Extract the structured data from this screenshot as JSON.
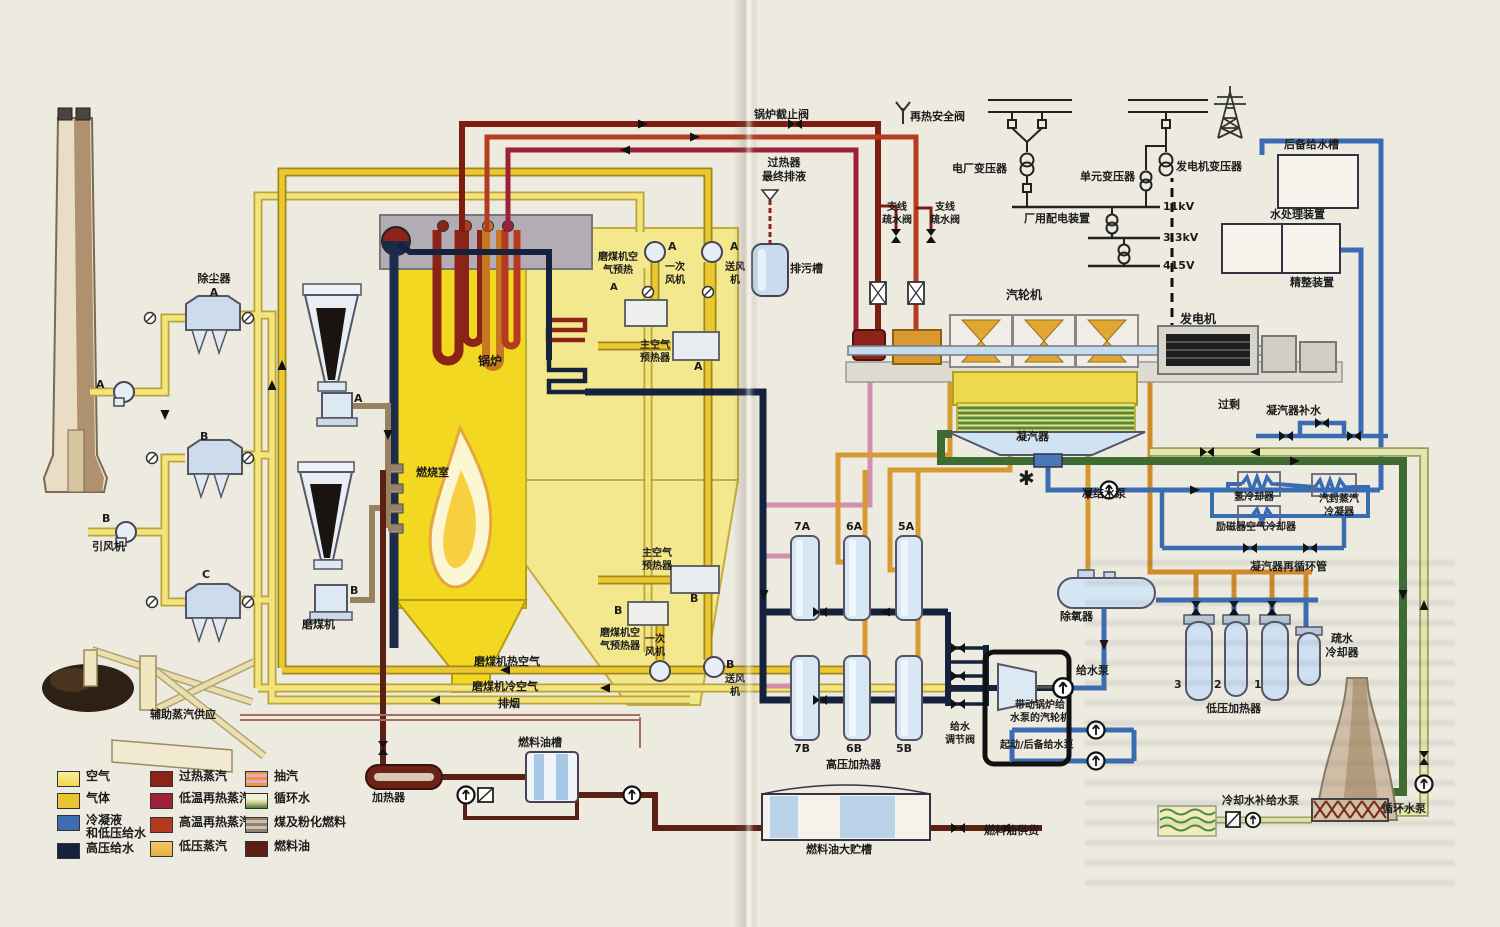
{
  "colors": {
    "air": "#f4e47e",
    "gas": "#ecc830",
    "condensate": "#3a6cb4",
    "hp_feedwater": "#15223d",
    "superheated_steam": "#7f1d10",
    "reheat_low": "#9c2038",
    "reheat_high": "#b43b20",
    "lp_steam": "#d79a30",
    "extraction": "#d58fae",
    "circulating_water": "#3d6c32",
    "circulating_return": "#e4e6ae",
    "coal": "#97815f",
    "fuel_oil": "#5a2014"
  },
  "legend": {
    "items": [
      {
        "label": "空气",
        "color": "#f5df55"
      },
      {
        "label": "气体",
        "color": "#eac431"
      },
      {
        "label": "冷凝液\n和低压给水",
        "color": "#3e6db4"
      },
      {
        "label": "高压给水",
        "color": "#15223d"
      },
      {
        "label": "过热蒸汽",
        "color": "#8c2318"
      },
      {
        "label": "低温再热蒸汽",
        "color": "#9e1f38"
      },
      {
        "label": "高温再热蒸汽",
        "color": "#b23a20"
      },
      {
        "label": "低压蒸汽",
        "color": "#e7af3d"
      },
      {
        "label": "抽汽",
        "color": "#e39bb0"
      },
      {
        "label": "循环水",
        "color": "#4c7c3a"
      },
      {
        "label": "煤及粉化燃料",
        "color": "#93836f"
      },
      {
        "label": "燃料油",
        "color": "#5b2013"
      }
    ]
  },
  "labels": {
    "dust_collector_a": "除尘器\nA",
    "dust_collector_b": "B",
    "dust_collector_c": "C",
    "id_fan_a_letter": "A",
    "id_fan_b_letter": "B",
    "id_fan": "引风机",
    "mill_a_letter": "A",
    "mill_b_letter": "B",
    "mill": "磨煤机",
    "aux_steam": "辅助蒸汽供应",
    "boiler": "锅炉",
    "combustion_chamber": "燃烧室",
    "mill_air_preheat_a": "磨煤机空\n气预热",
    "mill_air_preheat_a_letter": "A",
    "pa_fan_a": "一次\n风机",
    "pa_fan_a_letter": "A",
    "fd_fan_a": "送风\n机",
    "fd_fan_a_letter": "A",
    "main_air_preheater_a": "主空气\n预热器",
    "main_air_preheater_a_letter": "A",
    "main_air_preheater_b": "主空气\n预热器",
    "main_air_preheater_b_letter": "B",
    "mill_air_preheater_b": "磨煤机空\n气预热器",
    "mill_air_preheater_b_letter": "B",
    "pa_fan_b": "一次\n风机",
    "fd_fan_b": "送风\n机",
    "fd_fan_b_letter": "B",
    "boiler_stop_valve": "锅炉截止阀",
    "reheat_safety_valve": "再热安全阀",
    "superheater_final_drain": "过热器\n最终排液",
    "blowdown_tank": "排污槽",
    "branch_drain_valve_1": "支线\n疏水阀",
    "branch_drain_valve_2": "支线\n疏水阀",
    "plant_transformer": "电厂变压器",
    "unit_transformer": "单元变压器",
    "generator_transformer": "发电机变压器",
    "plant_distribution": "厂用配电装置",
    "v11": "11kV",
    "v33": "3.3kV",
    "v415": "415V",
    "backup_feedwater_tank": "后备给水槽",
    "water_treatment": "水处理装置",
    "polishing_unit": "精整装置",
    "turbine": "汽轮机",
    "generator": "发电机",
    "condenser": "凝汽器",
    "excess": "过剩",
    "condenser_makeup": "凝汽器补水",
    "condensate_pump": "凝结水泵",
    "hydrogen_cooler": "氢冷却器",
    "gland_steam_condenser": "汽封蒸汽\n冷凝器",
    "exciter_air_cooler": "励磁器空气冷却器",
    "condenser_recirc": "凝汽器再循环管",
    "drain_cooler": "疏水\n冷却器",
    "deaerator": "除氧器",
    "feed_pump": "给水泵",
    "bfp_turbine": "带动锅炉给\n水泵的汽轮机",
    "startup_backup_pump": "起动/后备给水泵",
    "fw_reg_valve": "给水\n调节阀",
    "hp7a": "7A",
    "hp6a": "6A",
    "hp5a": "5A",
    "hp7b": "7B",
    "hp6b": "6B",
    "hp5b": "5B",
    "hp_heaters": "高压加热器",
    "lp3": "3",
    "lp2": "2",
    "lp1": "1",
    "lp_heaters": "低压加热器",
    "cooling_makeup_pump": "冷却水补给水泵",
    "circ_pump": "循环水泵",
    "mill_hot_air": "磨煤机热空气",
    "mill_cold_air": "磨煤机冷空气",
    "flue_exhaust": "排烟",
    "oil_heater": "加热器",
    "fuel_oil_tank": "燃料油槽",
    "fuel_oil_storage": "燃料油大贮槽",
    "fuel_oil_supply": "燃料油供货",
    "asterisk": "✱"
  }
}
